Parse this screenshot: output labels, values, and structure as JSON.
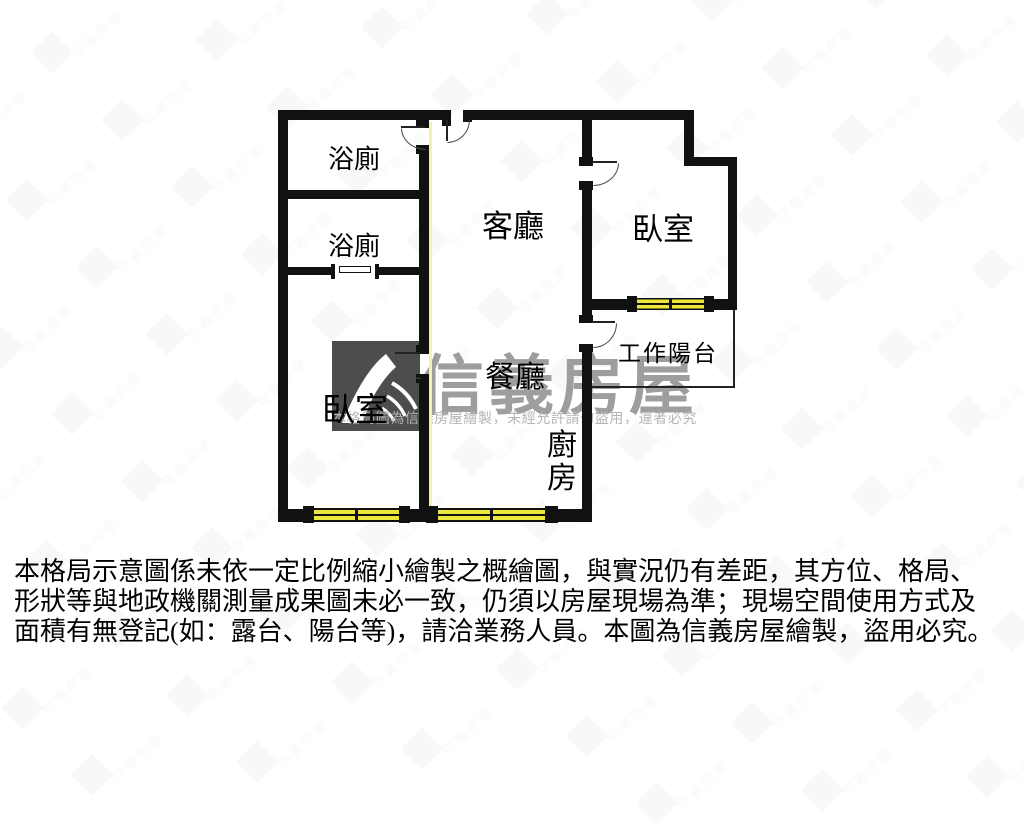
{
  "floorplan": {
    "labels": {
      "bath_top": "浴廁",
      "bath_mid": "浴廁",
      "living": "客廳",
      "bedroom_right": "臥室",
      "bedroom_left": "臥室",
      "dining": "餐廳",
      "kitchen": "廚房",
      "balcony": "工作陽台"
    },
    "colors": {
      "wall": "#111111",
      "window_yellow": "#ece73c",
      "watermark_box": "#4d4d4d",
      "watermark_brand": "#9e9e9e",
      "watermark_small": "#b5b5b5"
    }
  },
  "watermark": {
    "brand": "信義房屋",
    "notice": "本格局圖為信義房屋繪製，未經允許請勿盜用，違者必究",
    "tile_text": "信義房屋",
    "logo_icon": "sinyi-mountain-bird-logo"
  },
  "disclaimer": {
    "line1": "本格局示意圖係未依一定比例縮小繪製之概繪圖，與實況仍有差距，其方位、格局、",
    "line2": "形狀等與地政機關測量成果圖未必一致，仍須以房屋現場為準；現場空間使用方式及",
    "line3": "面積有無登記(如：露台、陽台等)，請洽業務人員。本圖為信義房屋繪製，盜用必究。"
  }
}
